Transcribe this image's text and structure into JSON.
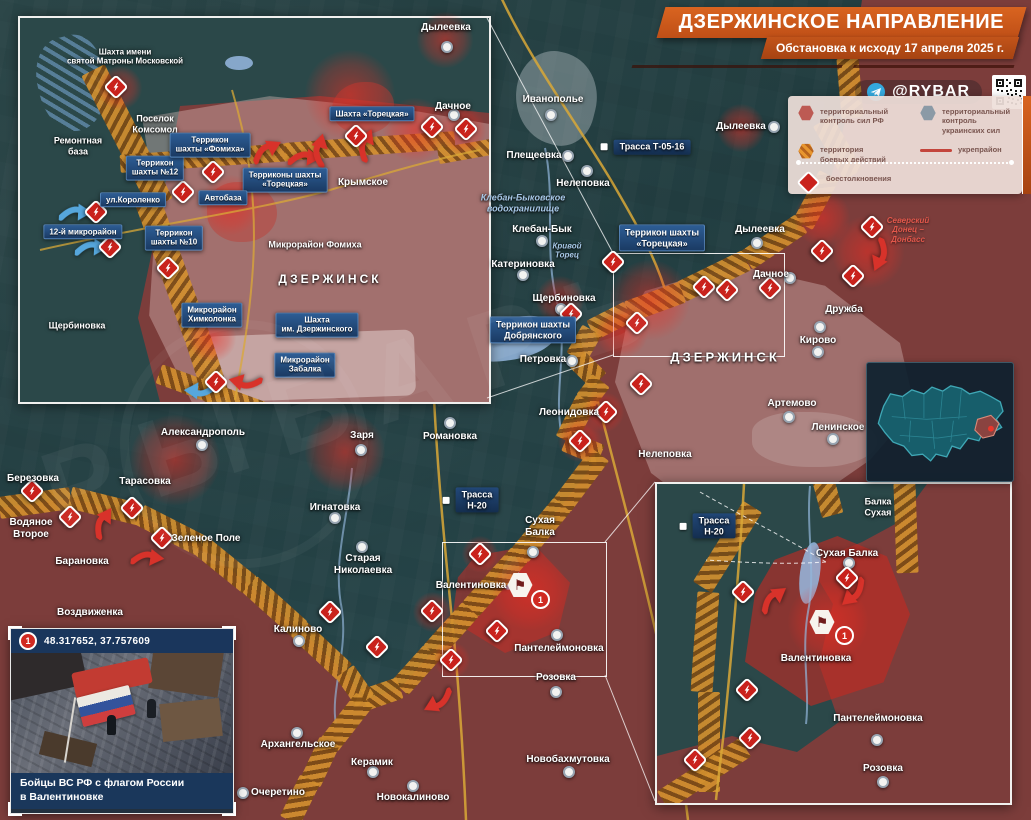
{
  "header": {
    "title": "ДЗЕРЖИНСКОЕ НАПРАВЛЕНИЕ",
    "subtitle": "Обстановка к исходу 17 апреля 2025 г.",
    "channel": "@RYBAR"
  },
  "legend": {
    "items": [
      {
        "symbol": "hex-red",
        "label": "территориальный\nконтроль сил РФ"
      },
      {
        "symbol": "hex-gray",
        "label": "территориальный\nконтроль украинских сил"
      },
      {
        "symbol": "hex-striped",
        "label": "территория\nбоевых действий"
      },
      {
        "symbol": "line-red",
        "label": "укрепрайон"
      },
      {
        "symbol": "diamond-lightning",
        "label": "боестолкновения"
      }
    ]
  },
  "photo_inset": {
    "badge": "1",
    "coords": "48.317652, 37.757609",
    "caption": "Бойцы ВС РФ с флагом России\nв Валентиновке"
  },
  "watermark": "РЫБАРЬ",
  "map": {
    "labels": [
      {
        "x": 125,
        "y": 57,
        "t": "Шахта имени\nсвятой Матроны Московской",
        "k": "p",
        "s": 8
      },
      {
        "x": 155,
        "y": 124,
        "t": "Поселок\nКомсомол",
        "k": "p",
        "s": 9
      },
      {
        "x": 78,
        "y": 146,
        "t": "Ремонтная\nбаза",
        "k": "p",
        "s": 9
      },
      {
        "x": 155,
        "y": 168,
        "t": "Террикон\nшахты №12",
        "k": "i",
        "s": 8
      },
      {
        "x": 210,
        "y": 145,
        "t": "Террикон\nшахты «Фомиха»",
        "k": "i",
        "s": 8
      },
      {
        "x": 285,
        "y": 180,
        "t": "Терриконы шахты\n«Торецкая»",
        "k": "i",
        "s": 8
      },
      {
        "x": 133,
        "y": 200,
        "t": "ул.Короленко",
        "k": "i",
        "s": 8
      },
      {
        "x": 223,
        "y": 198,
        "t": "Автобаза",
        "k": "i",
        "s": 8
      },
      {
        "x": 83,
        "y": 232,
        "t": "12-й микрорайон",
        "k": "i",
        "s": 8
      },
      {
        "x": 174,
        "y": 238,
        "t": "Террикон\nшахты №10",
        "k": "i",
        "s": 8
      },
      {
        "x": 315,
        "y": 245,
        "t": "Микрорайон Фомиха",
        "k": "p",
        "s": 9
      },
      {
        "x": 330,
        "y": 279,
        "t": "ДЗЕРЖИНСК",
        "k": "c",
        "s": 12
      },
      {
        "x": 77,
        "y": 326,
        "t": "Щербиновка",
        "k": "p",
        "s": 9
      },
      {
        "x": 212,
        "y": 315,
        "t": "Микрорайон\nХимколонка",
        "k": "i",
        "s": 8
      },
      {
        "x": 317,
        "y": 325,
        "t": "Шахта\nим. Дзержинского",
        "k": "i",
        "s": 8
      },
      {
        "x": 305,
        "y": 365,
        "t": "Микрорайон\nЗабалка",
        "k": "i",
        "s": 8
      },
      {
        "x": 446,
        "y": 28,
        "t": "Дылеевка",
        "k": "p"
      },
      {
        "x": 453,
        "y": 107,
        "t": "Дачное",
        "k": "p"
      },
      {
        "x": 372,
        "y": 114,
        "t": "Шахта «Торецкая»",
        "k": "i",
        "s": 8
      },
      {
        "x": 363,
        "y": 183,
        "t": "Крымское",
        "k": "p"
      },
      {
        "x": 553,
        "y": 100,
        "t": "Иванополье",
        "k": "p"
      },
      {
        "x": 534,
        "y": 156,
        "t": "Плещеевка",
        "k": "p"
      },
      {
        "x": 583,
        "y": 184,
        "t": "Нелеповка",
        "k": "p"
      },
      {
        "x": 652,
        "y": 147,
        "t": "Трасса Т-05-16",
        "k": "r",
        "s": 9
      },
      {
        "x": 523,
        "y": 203,
        "t": "Клебан-Быковское\nводохранилище",
        "k": "w",
        "s": 9
      },
      {
        "x": 542,
        "y": 230,
        "t": "Клебан-Бык",
        "k": "p"
      },
      {
        "x": 567,
        "y": 251,
        "t": "Кривой\nТорец",
        "k": "w",
        "s": 8
      },
      {
        "x": 523,
        "y": 265,
        "t": "Катериновка",
        "k": "p"
      },
      {
        "x": 564,
        "y": 299,
        "t": "Щербиновка",
        "k": "p"
      },
      {
        "x": 533,
        "y": 330,
        "t": "Террикон шахты\nДобрянского",
        "k": "i",
        "s": 9
      },
      {
        "x": 543,
        "y": 360,
        "t": "Петровка",
        "k": "p"
      },
      {
        "x": 741,
        "y": 127,
        "t": "Дылеевка",
        "k": "p"
      },
      {
        "x": 760,
        "y": 230,
        "t": "Дылеевка",
        "k": "p"
      },
      {
        "x": 662,
        "y": 238,
        "t": "Террикон шахты\n«Торецкая»",
        "k": "i",
        "s": 9
      },
      {
        "x": 771,
        "y": 275,
        "t": "Дачное",
        "k": "p"
      },
      {
        "x": 844,
        "y": 310,
        "t": "Дружба",
        "k": "p"
      },
      {
        "x": 725,
        "y": 357,
        "t": "ДЗЕРЖИНСК",
        "k": "c",
        "s": 13
      },
      {
        "x": 818,
        "y": 341,
        "t": "Кирово",
        "k": "p"
      },
      {
        "x": 908,
        "y": 230,
        "t": "Северский\nДонец –\nДонбасс",
        "k": "n",
        "s": 8
      },
      {
        "x": 792,
        "y": 404,
        "t": "Артемово",
        "k": "p"
      },
      {
        "x": 838,
        "y": 428,
        "t": "Ленинское",
        "k": "p"
      },
      {
        "x": 665,
        "y": 455,
        "t": "Нелеповка",
        "k": "p"
      },
      {
        "x": 569,
        "y": 413,
        "t": "Леонидовка",
        "k": "p"
      },
      {
        "x": 203,
        "y": 433,
        "t": "Александрополь",
        "k": "p"
      },
      {
        "x": 362,
        "y": 436,
        "t": "Заря",
        "k": "p"
      },
      {
        "x": 450,
        "y": 437,
        "t": "Романовка",
        "k": "p"
      },
      {
        "x": 33,
        "y": 479,
        "t": "Березовка",
        "k": "p"
      },
      {
        "x": 145,
        "y": 482,
        "t": "Тарасовка",
        "k": "p"
      },
      {
        "x": 31,
        "y": 529,
        "t": "Водяное\nВторое",
        "k": "p"
      },
      {
        "x": 206,
        "y": 539,
        "t": "Зеленое Поле",
        "k": "p"
      },
      {
        "x": 82,
        "y": 562,
        "t": "Барановка",
        "k": "p"
      },
      {
        "x": 90,
        "y": 613,
        "t": "Воздвиженка",
        "k": "p"
      },
      {
        "x": 335,
        "y": 508,
        "t": "Игнатовка",
        "k": "p"
      },
      {
        "x": 363,
        "y": 565,
        "t": "Старая\nНиколаевка",
        "k": "p"
      },
      {
        "x": 477,
        "y": 500,
        "t": "Трасса\nН-20",
        "k": "r",
        "s": 9
      },
      {
        "x": 540,
        "y": 527,
        "t": "Сухая\nБалка",
        "k": "p"
      },
      {
        "x": 471,
        "y": 586,
        "t": "Валентиновка",
        "k": "p"
      },
      {
        "x": 298,
        "y": 630,
        "t": "Калиново",
        "k": "p"
      },
      {
        "x": 559,
        "y": 649,
        "t": "Пантелеймоновка",
        "k": "p"
      },
      {
        "x": 556,
        "y": 678,
        "t": "Розовка",
        "k": "p"
      },
      {
        "x": 298,
        "y": 745,
        "t": "Архангельское",
        "k": "p"
      },
      {
        "x": 372,
        "y": 763,
        "t": "Керамик",
        "k": "p"
      },
      {
        "x": 278,
        "y": 793,
        "t": "Очеретино",
        "k": "p"
      },
      {
        "x": 413,
        "y": 798,
        "t": "Новокалиново",
        "k": "p"
      },
      {
        "x": 568,
        "y": 760,
        "t": "Новобахмутовка",
        "k": "p"
      },
      {
        "x": 878,
        "y": 507,
        "t": "Балка\nСухая",
        "k": "p",
        "s": 9
      },
      {
        "x": 847,
        "y": 554,
        "t": "Сухая Балка",
        "k": "p"
      },
      {
        "x": 714,
        "y": 526,
        "t": "Трасса\nН-20",
        "k": "r",
        "s": 9
      },
      {
        "x": 816,
        "y": 659,
        "t": "Валентиновка",
        "k": "p"
      },
      {
        "x": 878,
        "y": 719,
        "t": "Пантелеймоновка",
        "k": "p"
      },
      {
        "x": 883,
        "y": 769,
        "t": "Розовка",
        "k": "p"
      }
    ],
    "clash_icons": [
      [
        116,
        87
      ],
      [
        213,
        172
      ],
      [
        183,
        192
      ],
      [
        96,
        212
      ],
      [
        110,
        247
      ],
      [
        168,
        268
      ],
      [
        216,
        382
      ],
      [
        356,
        136
      ],
      [
        432,
        127
      ],
      [
        466,
        129
      ],
      [
        613,
        262
      ],
      [
        571,
        314
      ],
      [
        637,
        323
      ],
      [
        606,
        412
      ],
      [
        641,
        384
      ],
      [
        580,
        441
      ],
      [
        704,
        287
      ],
      [
        727,
        290
      ],
      [
        770,
        288
      ],
      [
        822,
        251
      ],
      [
        853,
        276
      ],
      [
        872,
        227
      ],
      [
        330,
        612
      ],
      [
        377,
        647
      ],
      [
        432,
        611
      ],
      [
        451,
        660
      ],
      [
        497,
        631
      ],
      [
        162,
        538
      ],
      [
        32,
        491
      ],
      [
        70,
        517
      ],
      [
        132,
        508
      ],
      [
        480,
        554
      ],
      [
        743,
        592
      ],
      [
        847,
        578
      ],
      [
        747,
        690
      ],
      [
        750,
        738
      ],
      [
        695,
        760
      ]
    ],
    "arrows": [
      [
        268,
        152,
        -25,
        "red"
      ],
      [
        305,
        160,
        5,
        "red"
      ],
      [
        322,
        150,
        -75,
        "red"
      ],
      [
        368,
        145,
        -65,
        "red"
      ],
      [
        245,
        380,
        195,
        "red"
      ],
      [
        105,
        523,
        -55,
        "red"
      ],
      [
        148,
        560,
        8,
        "red"
      ],
      [
        437,
        700,
        155,
        "red"
      ],
      [
        775,
        600,
        -35,
        "red"
      ],
      [
        852,
        592,
        140,
        "red"
      ],
      [
        878,
        255,
        115,
        "red"
      ],
      [
        76,
        215,
        3,
        "blue"
      ],
      [
        92,
        250,
        3,
        "blue"
      ],
      [
        200,
        388,
        185,
        "blue"
      ]
    ],
    "dots": [
      [
        447,
        47
      ],
      [
        454,
        115
      ],
      [
        551,
        115
      ],
      [
        568,
        156
      ],
      [
        587,
        171
      ],
      [
        542,
        241
      ],
      [
        523,
        275
      ],
      [
        561,
        309
      ],
      [
        572,
        361
      ],
      [
        774,
        127
      ],
      [
        757,
        243
      ],
      [
        790,
        278
      ],
      [
        820,
        327
      ],
      [
        818,
        352
      ],
      [
        789,
        417
      ],
      [
        833,
        439
      ],
      [
        202,
        445
      ],
      [
        361,
        450
      ],
      [
        450,
        423
      ],
      [
        335,
        518
      ],
      [
        362,
        547
      ],
      [
        533,
        552
      ],
      [
        299,
        641
      ],
      [
        557,
        635
      ],
      [
        556,
        692
      ],
      [
        297,
        733
      ],
      [
        373,
        772
      ],
      [
        243,
        793
      ],
      [
        413,
        786
      ],
      [
        569,
        772
      ],
      [
        849,
        563
      ],
      [
        877,
        740
      ],
      [
        883,
        782
      ]
    ],
    "heat": [
      [
        350,
        95,
        45
      ],
      [
        445,
        40,
        28
      ],
      [
        120,
        88,
        22
      ],
      [
        415,
        130,
        32
      ],
      [
        462,
        130,
        24
      ],
      [
        230,
        205,
        30
      ],
      [
        212,
        338,
        24
      ],
      [
        650,
        300,
        40
      ],
      [
        622,
        332,
        26
      ],
      [
        868,
        252,
        36
      ],
      [
        741,
        128,
        24
      ],
      [
        822,
        218,
        28
      ],
      [
        560,
        300,
        24
      ],
      [
        604,
        412,
        20
      ],
      [
        175,
        460,
        45
      ],
      [
        345,
        452,
        40
      ],
      [
        530,
        592,
        38
      ],
      [
        828,
        622,
        40
      ],
      [
        580,
        440,
        22
      ],
      [
        480,
        554,
        18
      ],
      [
        433,
        612,
        20
      ],
      [
        452,
        660,
        18
      ]
    ],
    "flags": [
      [
        520,
        585
      ],
      [
        822,
        622
      ]
    ],
    "badges": [
      [
        539,
        598
      ],
      [
        843,
        634
      ]
    ],
    "badge_label": "1"
  }
}
